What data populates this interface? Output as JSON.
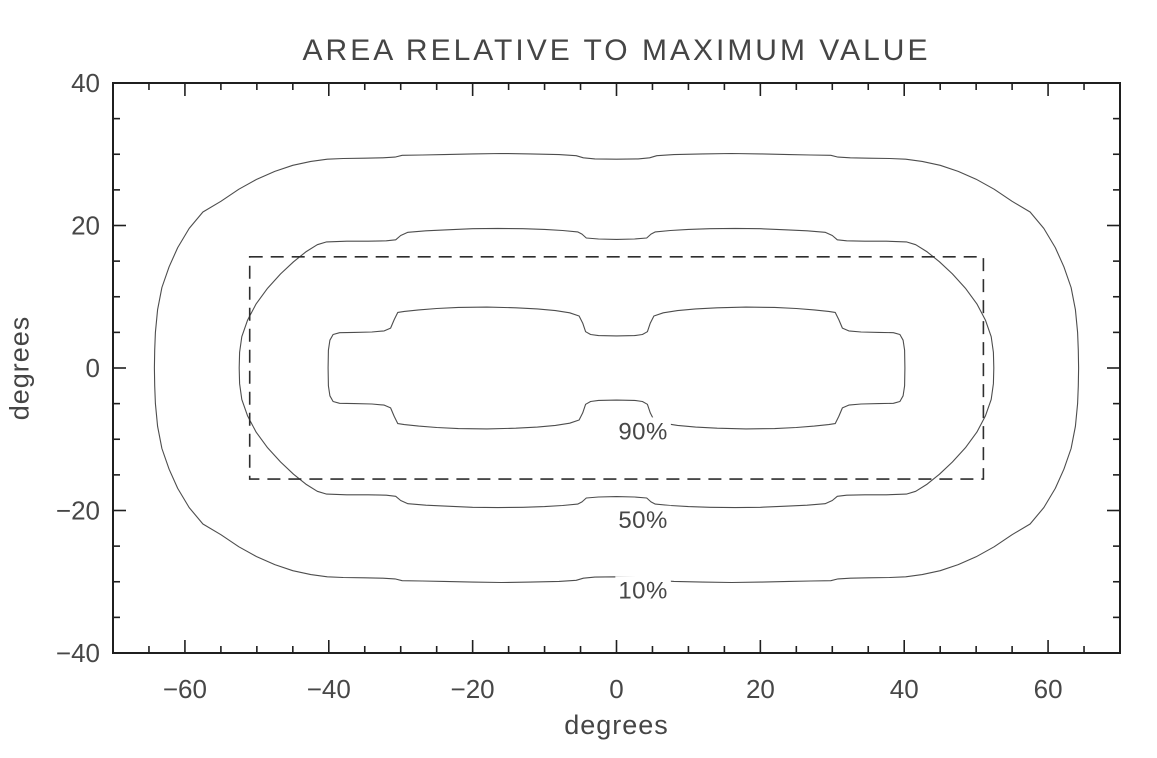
{
  "style": {
    "background": "#ffffff",
    "contour_line_color": "#4d4d4d",
    "axis_color": "#1f1f1f",
    "dash_color": "#2e2e2e",
    "text_color": "#474747"
  },
  "chart_data": {
    "type": "contour",
    "title": "AREA RELATIVE TO MAXIMUM VALUE",
    "xlabel": "degrees",
    "ylabel": "degrees",
    "xlim": [
      -70,
      70
    ],
    "ylim": [
      -40,
      40
    ],
    "grid": false,
    "x_major_ticks": [
      -60,
      -40,
      -20,
      0,
      20,
      40,
      60
    ],
    "x_major_tick_labels": [
      "−60",
      "−40",
      "−20",
      "0",
      "20",
      "40",
      "60"
    ],
    "x_minor_step": 5,
    "y_major_ticks": [
      -40,
      -20,
      0,
      20,
      40
    ],
    "y_major_tick_labels": [
      "−40",
      "−20",
      "0",
      "20",
      "40"
    ],
    "y_minor_step": 5,
    "contours": [
      {
        "label": "90%",
        "label_anchor_deg": [
          3.7,
          -8.9
        ],
        "symmetry": "quadrant",
        "quarter_outline_deg": [
          [
            0,
            4.5
          ],
          [
            2.5,
            4.55
          ],
          [
            3.6,
            4.7
          ],
          [
            4.3,
            5.1
          ],
          [
            4.7,
            6.3
          ],
          [
            5.2,
            7.3
          ],
          [
            6.5,
            7.75
          ],
          [
            8.5,
            8.05
          ],
          [
            11,
            8.3
          ],
          [
            14,
            8.45
          ],
          [
            18,
            8.55
          ],
          [
            22,
            8.5
          ],
          [
            25,
            8.35
          ],
          [
            27.5,
            8.15
          ],
          [
            29.5,
            7.95
          ],
          [
            30.4,
            7.8
          ],
          [
            30.9,
            6.8
          ],
          [
            31.4,
            5.6
          ],
          [
            32.3,
            5.2
          ],
          [
            34,
            5.05
          ],
          [
            36.5,
            5.0
          ],
          [
            38.5,
            4.95
          ],
          [
            39.4,
            4.7
          ],
          [
            39.85,
            3.9
          ],
          [
            40.05,
            2.5
          ],
          [
            40.1,
            0
          ]
        ]
      },
      {
        "label": "50%",
        "label_anchor_deg": [
          3.7,
          -21.3
        ],
        "symmetry": "quadrant",
        "quarter_outline_deg": [
          [
            0,
            18.05
          ],
          [
            2.5,
            18.1
          ],
          [
            4.2,
            18.25
          ],
          [
            4.8,
            18.8
          ],
          [
            5.4,
            19.1
          ],
          [
            7.5,
            19.3
          ],
          [
            10,
            19.45
          ],
          [
            13,
            19.55
          ],
          [
            16.5,
            19.6
          ],
          [
            20,
            19.55
          ],
          [
            23.5,
            19.4
          ],
          [
            26.5,
            19.25
          ],
          [
            29,
            19.05
          ],
          [
            30,
            18.6
          ],
          [
            30.7,
            18.0
          ],
          [
            32,
            17.85
          ],
          [
            34.5,
            17.8
          ],
          [
            37.5,
            17.8
          ],
          [
            40.3,
            17.7
          ],
          [
            41.6,
            17.3
          ],
          [
            43.2,
            16.3
          ],
          [
            44.9,
            14.9
          ],
          [
            46.7,
            13.2
          ],
          [
            48.5,
            11.2
          ],
          [
            50.1,
            9.0
          ],
          [
            51.3,
            6.7
          ],
          [
            52.1,
            4.4
          ],
          [
            52.4,
            2.2
          ],
          [
            52.45,
            0
          ]
        ]
      },
      {
        "label": "10%",
        "label_anchor_deg": [
          3.7,
          -31.2
        ],
        "symmetry": "quadrant",
        "quarter_outline_deg": [
          [
            0,
            29.3
          ],
          [
            3,
            29.35
          ],
          [
            4.6,
            29.5
          ],
          [
            5.6,
            29.8
          ],
          [
            8,
            29.95
          ],
          [
            12,
            30.05
          ],
          [
            16,
            30.1
          ],
          [
            20,
            30.05
          ],
          [
            24,
            29.95
          ],
          [
            27,
            29.9
          ],
          [
            29.8,
            29.85
          ],
          [
            30.8,
            29.6
          ],
          [
            32.5,
            29.5
          ],
          [
            35,
            29.45
          ],
          [
            38,
            29.4
          ],
          [
            40.2,
            29.3
          ],
          [
            42.5,
            29.0
          ],
          [
            45,
            28.45
          ],
          [
            47.5,
            27.6
          ],
          [
            50,
            26.5
          ],
          [
            52.5,
            25.1
          ],
          [
            55,
            23.4
          ],
          [
            57.5,
            21.9
          ],
          [
            59.4,
            19.6
          ],
          [
            61.0,
            16.9
          ],
          [
            62.2,
            14.2
          ],
          [
            63.2,
            11.3
          ],
          [
            63.8,
            8.2
          ],
          [
            64.1,
            5.0
          ],
          [
            64.2,
            2.5
          ],
          [
            64.25,
            0
          ]
        ]
      }
    ],
    "dashed_box": {
      "x": [
        -51,
        51
      ],
      "y": [
        -15.6,
        15.6
      ]
    }
  }
}
